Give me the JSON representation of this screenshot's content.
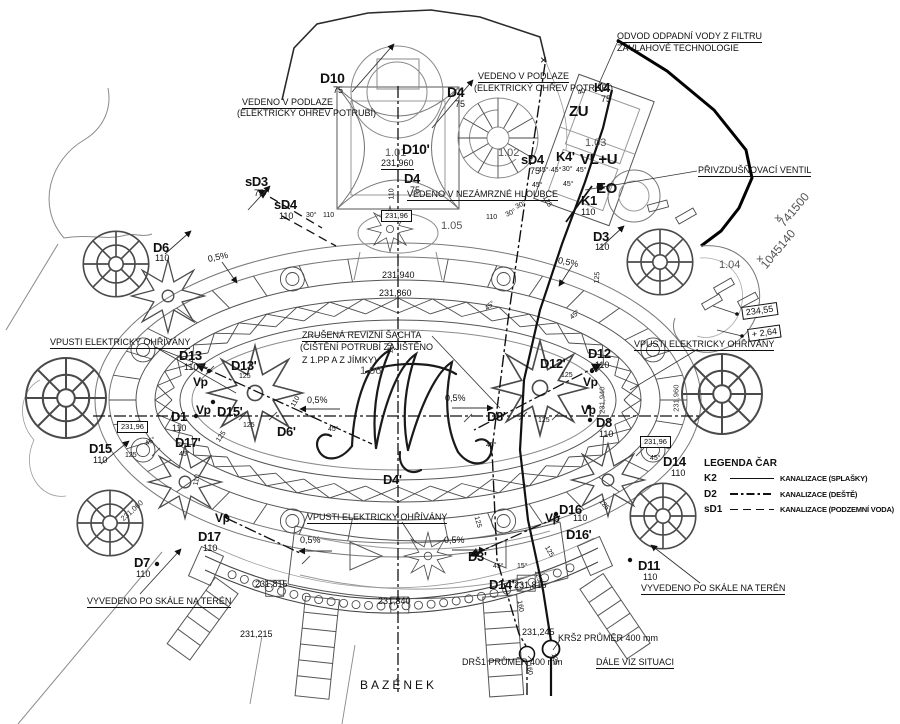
{
  "drawing": {
    "background": "#ffffff",
    "ink": "#111111",
    "medium": "#4a4a4a",
    "light": "#8a8a8a"
  },
  "legend": {
    "title": "LEGENDA ČAR",
    "items": [
      {
        "code": "K2",
        "label": "KANALIZACE (SPLAŠKY)",
        "style": "solid"
      },
      {
        "code": "D2",
        "label": "KANALIZACE (DEŠTĚ)",
        "style": "dashdot"
      },
      {
        "code": "sD1",
        "label": "KANALIZACE (PODZEMNÍ VODA)",
        "style": "dashed"
      }
    ]
  },
  "labels": [
    {
      "n": "note-odvod-1",
      "t": "ODVOD ODPADNÍ VODY Z FILTRU",
      "x": 617,
      "y": 32,
      "u": 1
    },
    {
      "n": "note-odvod-2",
      "t": "ZÁVLAHOVÉ TECHNOLOGIE",
      "x": 617,
      "y": 44
    },
    {
      "n": "cross-mark",
      "t": "×",
      "x": 540,
      "y": 54,
      "fs": 12
    },
    {
      "n": "label-d10",
      "t": "D10",
      "x": 320,
      "y": 71,
      "fs": 14,
      "b": 1
    },
    {
      "n": "label-d10-dn",
      "t": "75",
      "x": 333,
      "y": 86
    },
    {
      "n": "note-vedeno-podlaze-r1",
      "t": "VEDENO V PODLAZE",
      "x": 478,
      "y": 72,
      "u": 1
    },
    {
      "n": "note-vedeno-podlaze-r2",
      "t": "(ELEKTRICKÝ OHŘEV POTRUBÍ)",
      "x": 474,
      "y": 84
    },
    {
      "n": "label-d4-top",
      "t": "D4",
      "x": 447,
      "y": 85,
      "fs": 14,
      "b": 1
    },
    {
      "n": "label-d4-top-dn",
      "t": "75",
      "x": 455,
      "y": 100
    },
    {
      "n": "label-k4",
      "t": "K4",
      "x": 594,
      "y": 81,
      "fs": 13,
      "b": 1
    },
    {
      "n": "label-k4-dn",
      "t": "75",
      "x": 601,
      "y": 95
    },
    {
      "n": "dim-40",
      "t": "40",
      "x": 578,
      "y": 90,
      "fs": 7,
      "r": -20
    },
    {
      "n": "note-vedeno-podlaze-l1",
      "t": "VEDENO V PODLAZE",
      "x": 242,
      "y": 98,
      "u": 1
    },
    {
      "n": "note-vedeno-podlaze-l2",
      "t": "(ELEKTRICKÝ OHŘEV POTRUBÍ)",
      "x": 237,
      "y": 109
    },
    {
      "n": "label-zu",
      "t": "ZU",
      "x": 569,
      "y": 104,
      "fs": 15,
      "b": 1
    },
    {
      "n": "room-101",
      "t": "1.01",
      "x": 385,
      "y": 148,
      "fs": 11,
      "c": "#555555"
    },
    {
      "n": "label-d10p",
      "t": "D10'",
      "x": 402,
      "y": 142,
      "fs": 14,
      "b": 1
    },
    {
      "n": "elev-231960-top",
      "t": "231,960",
      "x": 381,
      "y": 159,
      "u": 1
    },
    {
      "n": "room-102",
      "t": "1.02",
      "x": 498,
      "y": 148,
      "fs": 11,
      "c": "#555555"
    },
    {
      "n": "room-103",
      "t": "1.03",
      "x": 585,
      "y": 138,
      "fs": 11,
      "c": "#555555"
    },
    {
      "n": "label-sd4-mid",
      "t": "sD4",
      "x": 521,
      "y": 153,
      "fs": 13,
      "b": 1
    },
    {
      "n": "label-sd4-mid-dn",
      "t": "75",
      "x": 530,
      "y": 167
    },
    {
      "n": "label-k4p",
      "t": "K4'",
      "x": 556,
      "y": 150,
      "fs": 13,
      "b": 1
    },
    {
      "n": "label-vlu",
      "t": "VL+U",
      "x": 580,
      "y": 152,
      "fs": 15,
      "b": 1
    },
    {
      "n": "label-eo",
      "t": "EO",
      "x": 596,
      "y": 181,
      "fs": 15,
      "b": 1
    },
    {
      "n": "angle-top-a",
      "t": "45°·45°",
      "x": 538,
      "y": 167,
      "fs": 7
    },
    {
      "n": "angle-top-b",
      "t": "30°",
      "x": 562,
      "y": 166,
      "fs": 7
    },
    {
      "n": "angle-top-c",
      "t": "45°",
      "x": 576,
      "y": 167,
      "fs": 7
    },
    {
      "n": "angle-top-d",
      "t": "45°",
      "x": 532,
      "y": 182,
      "fs": 7
    },
    {
      "n": "angle-top-e",
      "t": "45°",
      "x": 563,
      "y": 181,
      "fs": 7
    },
    {
      "n": "label-d4-mid",
      "t": "D4",
      "x": 404,
      "y": 172,
      "fs": 13,
      "b": 1
    },
    {
      "n": "label-d4-mid-dn",
      "t": "75",
      "x": 410,
      "y": 186
    },
    {
      "n": "dim-110-d4",
      "t": "110",
      "x": 392,
      "y": 196,
      "fs": 7,
      "r": -90
    },
    {
      "n": "label-sd3",
      "t": "sD3",
      "x": 245,
      "y": 175,
      "fs": 13,
      "b": 1
    },
    {
      "n": "label-sd3-dn",
      "t": "75",
      "x": 254,
      "y": 189
    },
    {
      "n": "note-nezamrzne",
      "t": "VEDENO V NEZÁMRZNÉ HLOUBCE",
      "x": 407,
      "y": 190,
      "u": 1
    },
    {
      "n": "label-k1",
      "t": "K1",
      "x": 581,
      "y": 194,
      "fs": 13,
      "b": 1
    },
    {
      "n": "label-k1-dn",
      "t": "110",
      "x": 581,
      "y": 208
    },
    {
      "n": "label-sd4-left",
      "t": "sD4",
      "x": 274,
      "y": 198,
      "fs": 13,
      "b": 1
    },
    {
      "n": "label-sd4-left-dn",
      "t": "110",
      "x": 279,
      "y": 212
    },
    {
      "n": "note-privzdus",
      "t": "PŘIVZDUŠŇOVACÍ VENTIL",
      "x": 698,
      "y": 166,
      "u": 1
    },
    {
      "n": "coord-x",
      "t": "741500",
      "x": 781,
      "y": 219,
      "fs": 12,
      "r": -50,
      "c": "#555555"
    },
    {
      "n": "coord-cross-1",
      "t": "+",
      "x": 774,
      "y": 211,
      "fs": 13,
      "c": "#555555"
    },
    {
      "n": "coord-y",
      "t": "1045140",
      "x": 763,
      "y": 261,
      "fs": 12,
      "r": -50,
      "c": "#555555"
    },
    {
      "n": "coord-cross-2",
      "t": "+",
      "x": 756,
      "y": 252,
      "fs": 13,
      "c": "#555555"
    },
    {
      "n": "angle-30-left",
      "t": "30°",
      "x": 306,
      "y": 212,
      "fs": 7
    },
    {
      "n": "dim-110-a",
      "t": "110",
      "x": 323,
      "y": 212,
      "fs": 7
    },
    {
      "n": "elev-23196-box-top",
      "t": "231,96",
      "x": 381,
      "y": 210,
      "box": 1,
      "fs": 7.5
    },
    {
      "n": "room-105",
      "t": "1.05",
      "x": 441,
      "y": 221,
      "fs": 11,
      "c": "#555555"
    },
    {
      "n": "dim-110-b",
      "t": "110",
      "x": 486,
      "y": 214,
      "fs": 7
    },
    {
      "n": "angle-30-r1",
      "t": "30°",
      "x": 506,
      "y": 212,
      "fs": 7,
      "r": -25
    },
    {
      "n": "angle-30-r2",
      "t": "30°",
      "x": 516,
      "y": 204,
      "fs": 7,
      "r": -25
    },
    {
      "n": "dim-125-rot-top",
      "t": "125",
      "x": 544,
      "y": 193,
      "fs": 7,
      "r": 60
    },
    {
      "n": "label-d6",
      "t": "D6",
      "x": 153,
      "y": 241,
      "fs": 13,
      "b": 1
    },
    {
      "n": "label-d6-dn",
      "t": "110",
      "x": 155,
      "y": 254
    },
    {
      "n": "label-d3",
      "t": "D3",
      "x": 593,
      "y": 230,
      "fs": 13,
      "b": 1
    },
    {
      "n": "label-d3-dn",
      "t": "110",
      "x": 595,
      "y": 243
    },
    {
      "n": "slope-nw",
      "t": "0,5%",
      "x": 208,
      "y": 255,
      "r": -12
    },
    {
      "n": "slope-ne",
      "t": "0,5%",
      "x": 558,
      "y": 256,
      "r": 12
    },
    {
      "n": "dim-125-rot-d3",
      "t": "125",
      "x": 597,
      "y": 280,
      "fs": 7,
      "r": -85
    },
    {
      "n": "room-104",
      "t": "1.04",
      "x": 719,
      "y": 260,
      "fs": 11,
      "c": "#555555"
    },
    {
      "n": "elev-231940",
      "t": "231,940",
      "x": 382,
      "y": 271
    },
    {
      "n": "elev-231860",
      "t": "231,860",
      "x": 379,
      "y": 289
    },
    {
      "n": "angle-45-k2",
      "t": "45°",
      "x": 571,
      "y": 315,
      "fs": 7,
      "r": -40
    },
    {
      "n": "angle-45-mid",
      "t": "45°",
      "x": 486,
      "y": 306,
      "fs": 7,
      "r": -40
    },
    {
      "n": "elev-23455-box",
      "t": "234,55",
      "x": 742,
      "y": 307,
      "box": 1,
      "r": -8
    },
    {
      "n": "elev-264-box",
      "t": "+ 2,64",
      "x": 748,
      "y": 329,
      "box": 1,
      "r": -8
    },
    {
      "n": "note-zrusena-1",
      "t": "ZRUŠENÁ REVIZNÍ ŠACHTA",
      "x": 302,
      "y": 331,
      "u": 1
    },
    {
      "n": "note-zrusena-2",
      "t": "(ČIŠTĚNÍ POTRUBÍ ZAJIŠTĚNO",
      "x": 300,
      "y": 343
    },
    {
      "n": "note-zrusena-3",
      "t": "Z 1.PP A Z JÍMKY)",
      "x": 302,
      "y": 356
    },
    {
      "n": "dim-110-center-rot",
      "t": "110",
      "x": 391,
      "y": 350,
      "fs": 7,
      "r": -90
    },
    {
      "n": "note-vpusti-left",
      "t": "VPUSTI ELEKTRICKY OHŘÍVÁNY",
      "x": 50,
      "y": 338,
      "u": 1
    },
    {
      "n": "note-vpusti-right",
      "t": "VPUSTI ELEKTRICKY OHŘÍVÁNY",
      "x": 634,
      "y": 340,
      "u": 1
    },
    {
      "n": "label-d13",
      "t": "D13",
      "x": 179,
      "y": 349,
      "fs": 13,
      "b": 1
    },
    {
      "n": "label-d13-dn",
      "t": "110",
      "x": 184,
      "y": 363
    },
    {
      "n": "label-d13p",
      "t": "D13'",
      "x": 231,
      "y": 359,
      "fs": 13,
      "b": 1
    },
    {
      "n": "dim-125-a",
      "t": "125",
      "x": 239,
      "y": 373,
      "fs": 7
    },
    {
      "n": "label-d12p",
      "t": "D12'",
      "x": 540,
      "y": 357,
      "fs": 13,
      "b": 1
    },
    {
      "n": "dim-125-b",
      "t": "125",
      "x": 561,
      "y": 372,
      "fs": 7
    },
    {
      "n": "label-d12",
      "t": "D12",
      "x": 588,
      "y": 347,
      "fs": 13,
      "b": 1
    },
    {
      "n": "label-d12-dn",
      "t": "110",
      "x": 595,
      "y": 361
    },
    {
      "n": "label-vp-1",
      "t": "Vp",
      "x": 193,
      "y": 376,
      "fs": 12,
      "b": 1
    },
    {
      "n": "label-vp-2",
      "t": "Vp",
      "x": 583,
      "y": 376,
      "fs": 12,
      "b": 1
    },
    {
      "n": "room-106",
      "t": "1.06",
      "x": 360,
      "y": 366,
      "fs": 11,
      "c": "#555555"
    },
    {
      "n": "dim-110-rot-left",
      "t": "110",
      "x": 293,
      "y": 403,
      "fs": 7,
      "r": -60
    },
    {
      "n": "elev-231940-vert",
      "t": "231,940",
      "x": 602,
      "y": 410,
      "fs": 7.5,
      "r": -90,
      "c": "#333333"
    },
    {
      "n": "elev-231960-vert",
      "t": "231,960",
      "x": 676,
      "y": 408,
      "fs": 7.5,
      "r": -90,
      "c": "#333333"
    },
    {
      "n": "slope-mid-left",
      "t": "0,5%",
      "x": 307,
      "y": 396
    },
    {
      "n": "slope-mid-right",
      "t": "0,5%",
      "x": 445,
      "y": 394
    },
    {
      "n": "label-vp-3",
      "t": "Vp",
      "x": 196,
      "y": 404,
      "fs": 12,
      "b": 1
    },
    {
      "n": "label-d15p",
      "t": "D15'",
      "x": 217,
      "y": 405,
      "fs": 13,
      "b": 1
    },
    {
      "n": "label-d1",
      "t": "D1",
      "x": 171,
      "y": 410,
      "fs": 13,
      "b": 1
    },
    {
      "n": "label-d1-dn",
      "t": "110",
      "x": 172,
      "y": 424
    },
    {
      "n": "dim-125-c",
      "t": "125",
      "x": 243,
      "y": 422,
      "fs": 7
    },
    {
      "n": "label-d6p",
      "t": "D6'",
      "x": 277,
      "y": 425,
      "fs": 13,
      "b": 1
    },
    {
      "n": "angle-45-a",
      "t": "45°",
      "x": 328,
      "y": 426,
      "fs": 7
    },
    {
      "n": "label-d8p",
      "t": "D8'",
      "x": 487,
      "y": 410,
      "fs": 13,
      "b": 1
    },
    {
      "n": "dim-125-d",
      "t": "125",
      "x": 538,
      "y": 417,
      "fs": 7
    },
    {
      "n": "label-vp-4",
      "t": "Vp",
      "x": 581,
      "y": 404,
      "fs": 12,
      "b": 1
    },
    {
      "n": "label-d8",
      "t": "D8",
      "x": 596,
      "y": 416,
      "fs": 13,
      "b": 1
    },
    {
      "n": "label-d8-dn",
      "t": "110",
      "x": 599,
      "y": 430
    },
    {
      "n": "angle-45-d8l",
      "t": "45°",
      "x": 486,
      "y": 442,
      "fs": 7
    },
    {
      "n": "angle-45-d8r",
      "t": "45°",
      "x": 650,
      "y": 455,
      "fs": 7
    },
    {
      "n": "label-d17p",
      "t": "D17'",
      "x": 175,
      "y": 436,
      "fs": 13,
      "b": 1
    },
    {
      "n": "angle-45-d17",
      "t": "45°",
      "x": 179,
      "y": 451,
      "fs": 7
    },
    {
      "n": "dim-125-rot-d13",
      "t": "125",
      "x": 218,
      "y": 438,
      "fs": 7,
      "r": -55
    },
    {
      "n": "elev-23196-box-left",
      "t": "231,96",
      "x": 117,
      "y": 421,
      "box": 1,
      "fs": 7.5
    },
    {
      "n": "elev-23196-box-right",
      "t": "231,96",
      "x": 640,
      "y": 436,
      "box": 1,
      "fs": 7.5
    },
    {
      "n": "label-d15",
      "t": "D15",
      "x": 89,
      "y": 442,
      "fs": 13,
      "b": 1
    },
    {
      "n": "label-d15-dn",
      "t": "110",
      "x": 93,
      "y": 456
    },
    {
      "n": "dim-125-e",
      "t": "125",
      "x": 125,
      "y": 452,
      "fs": 7
    },
    {
      "n": "angle-45-d15",
      "t": "45°",
      "x": 146,
      "y": 441,
      "fs": 7,
      "r": -30
    },
    {
      "n": "dim-110-rot-d17",
      "t": "110",
      "x": 196,
      "y": 482,
      "fs": 7,
      "r": -80
    },
    {
      "n": "label-d14r",
      "t": "D14",
      "x": 663,
      "y": 455,
      "fs": 13,
      "b": 1
    },
    {
      "n": "label-d14r-dn",
      "t": "110",
      "x": 671,
      "y": 469
    },
    {
      "n": "label-d4p",
      "t": "D4'",
      "x": 383,
      "y": 473,
      "fs": 13,
      "b": 1
    },
    {
      "n": "elev-231060",
      "t": "231,060",
      "x": 122,
      "y": 516,
      "fs": 7.5,
      "r": -42,
      "c": "#333333"
    },
    {
      "n": "dim-125-rot-e",
      "t": "125",
      "x": 476,
      "y": 513,
      "fs": 7,
      "r": 75
    },
    {
      "n": "label-d16",
      "t": "D16",
      "x": 559,
      "y": 503,
      "fs": 13,
      "b": 1
    },
    {
      "n": "label-d16-dn",
      "t": "110",
      "x": 573,
      "y": 514
    },
    {
      "n": "label-vp-5",
      "t": "Vp",
      "x": 545,
      "y": 512,
      "fs": 12,
      "b": 1
    },
    {
      "n": "label-d16p",
      "t": "D16'",
      "x": 566,
      "y": 528,
      "fs": 13,
      "b": 1
    },
    {
      "n": "dim-125-rot-d16",
      "t": "125",
      "x": 600,
      "y": 497,
      "fs": 7,
      "r": 50
    },
    {
      "n": "dim-125-rot-d16b",
      "t": "125",
      "x": 546,
      "y": 543,
      "fs": 7,
      "r": 60
    },
    {
      "n": "label-vp-6",
      "t": "Vp",
      "x": 215,
      "y": 512,
      "fs": 12,
      "b": 1
    },
    {
      "n": "label-d17",
      "t": "D17",
      "x": 198,
      "y": 530,
      "fs": 13,
      "b": 1
    },
    {
      "n": "label-d17-dn",
      "t": "110",
      "x": 203,
      "y": 544
    },
    {
      "n": "note-vpusti-bottom",
      "t": "VPUSTI ELEKTRICKY OHŘÍVÁNY",
      "x": 307,
      "y": 513,
      "u": 1
    },
    {
      "n": "slope-bot-left",
      "t": "0,5%",
      "x": 300,
      "y": 536
    },
    {
      "n": "slope-bot-right",
      "t": "0,5%",
      "x": 444,
      "y": 536
    },
    {
      "n": "label-d3p",
      "t": "D3'",
      "x": 468,
      "y": 550,
      "fs": 13,
      "b": 1
    },
    {
      "n": "label-d7",
      "t": "D7",
      "x": 134,
      "y": 556,
      "fs": 13,
      "b": 1
    },
    {
      "n": "label-d7-dn",
      "t": "110",
      "x": 136,
      "y": 570
    },
    {
      "n": "angle-45-d14",
      "t": "45°",
      "x": 493,
      "y": 563,
      "fs": 7
    },
    {
      "n": "angle-15-d14",
      "t": "15°",
      "x": 517,
      "y": 563,
      "fs": 7
    },
    {
      "n": "label-d14p",
      "t": "D14'",
      "x": 489,
      "y": 578,
      "fs": 13,
      "b": 1
    },
    {
      "n": "elev-231815-c",
      "t": "231,815",
      "x": 514,
      "y": 581
    },
    {
      "n": "dim-125-rot-d14",
      "t": "125",
      "x": 536,
      "y": 567,
      "fs": 7,
      "r": 72
    },
    {
      "n": "dim-160-rot",
      "t": "160",
      "x": 519,
      "y": 597,
      "fs": 7,
      "r": 80
    },
    {
      "n": "label-d11",
      "t": "D11",
      "x": 638,
      "y": 559,
      "fs": 13,
      "b": 1
    },
    {
      "n": "label-d11-dn",
      "t": "110",
      "x": 643,
      "y": 573
    },
    {
      "n": "note-vyvedeno-right",
      "t": "VYVEDENO PO SKÁLE NA TERÉN",
      "x": 641,
      "y": 584,
      "u": 1
    },
    {
      "n": "elev-231815-l",
      "t": "231,815",
      "x": 255,
      "y": 580
    },
    {
      "n": "elev-231840",
      "t": "231,840",
      "x": 378,
      "y": 597
    },
    {
      "n": "note-vyvedeno-left",
      "t": "VYVEDENO PO SKÁLE NA TERÉN",
      "x": 87,
      "y": 597,
      "u": 1
    },
    {
      "n": "elev-231215",
      "t": "231,215",
      "x": 240,
      "y": 630
    },
    {
      "n": "elev-231245",
      "t": "231,245",
      "x": 522,
      "y": 628
    },
    {
      "n": "note-krs2",
      "t": "KRŠ2 PRŮMĚR 400 mm",
      "x": 558,
      "y": 634
    },
    {
      "n": "dim-125-rot-bot",
      "t": "125",
      "x": 553,
      "y": 650,
      "fs": 7,
      "r": 75
    },
    {
      "n": "dim-160-rot-bot",
      "t": "160",
      "x": 528,
      "y": 660,
      "fs": 7,
      "r": 80
    },
    {
      "n": "note-drs1",
      "t": "DRŠ1 PRŮMĚR 400 mm",
      "x": 462,
      "y": 658
    },
    {
      "n": "note-dale",
      "t": "DÁLE VIZ SITUACI",
      "x": 596,
      "y": 658,
      "u": 1
    },
    {
      "n": "title-bazenek",
      "t": "BAZÉNEK",
      "x": 360,
      "y": 679,
      "fs": 12,
      "ls": 3
    }
  ]
}
